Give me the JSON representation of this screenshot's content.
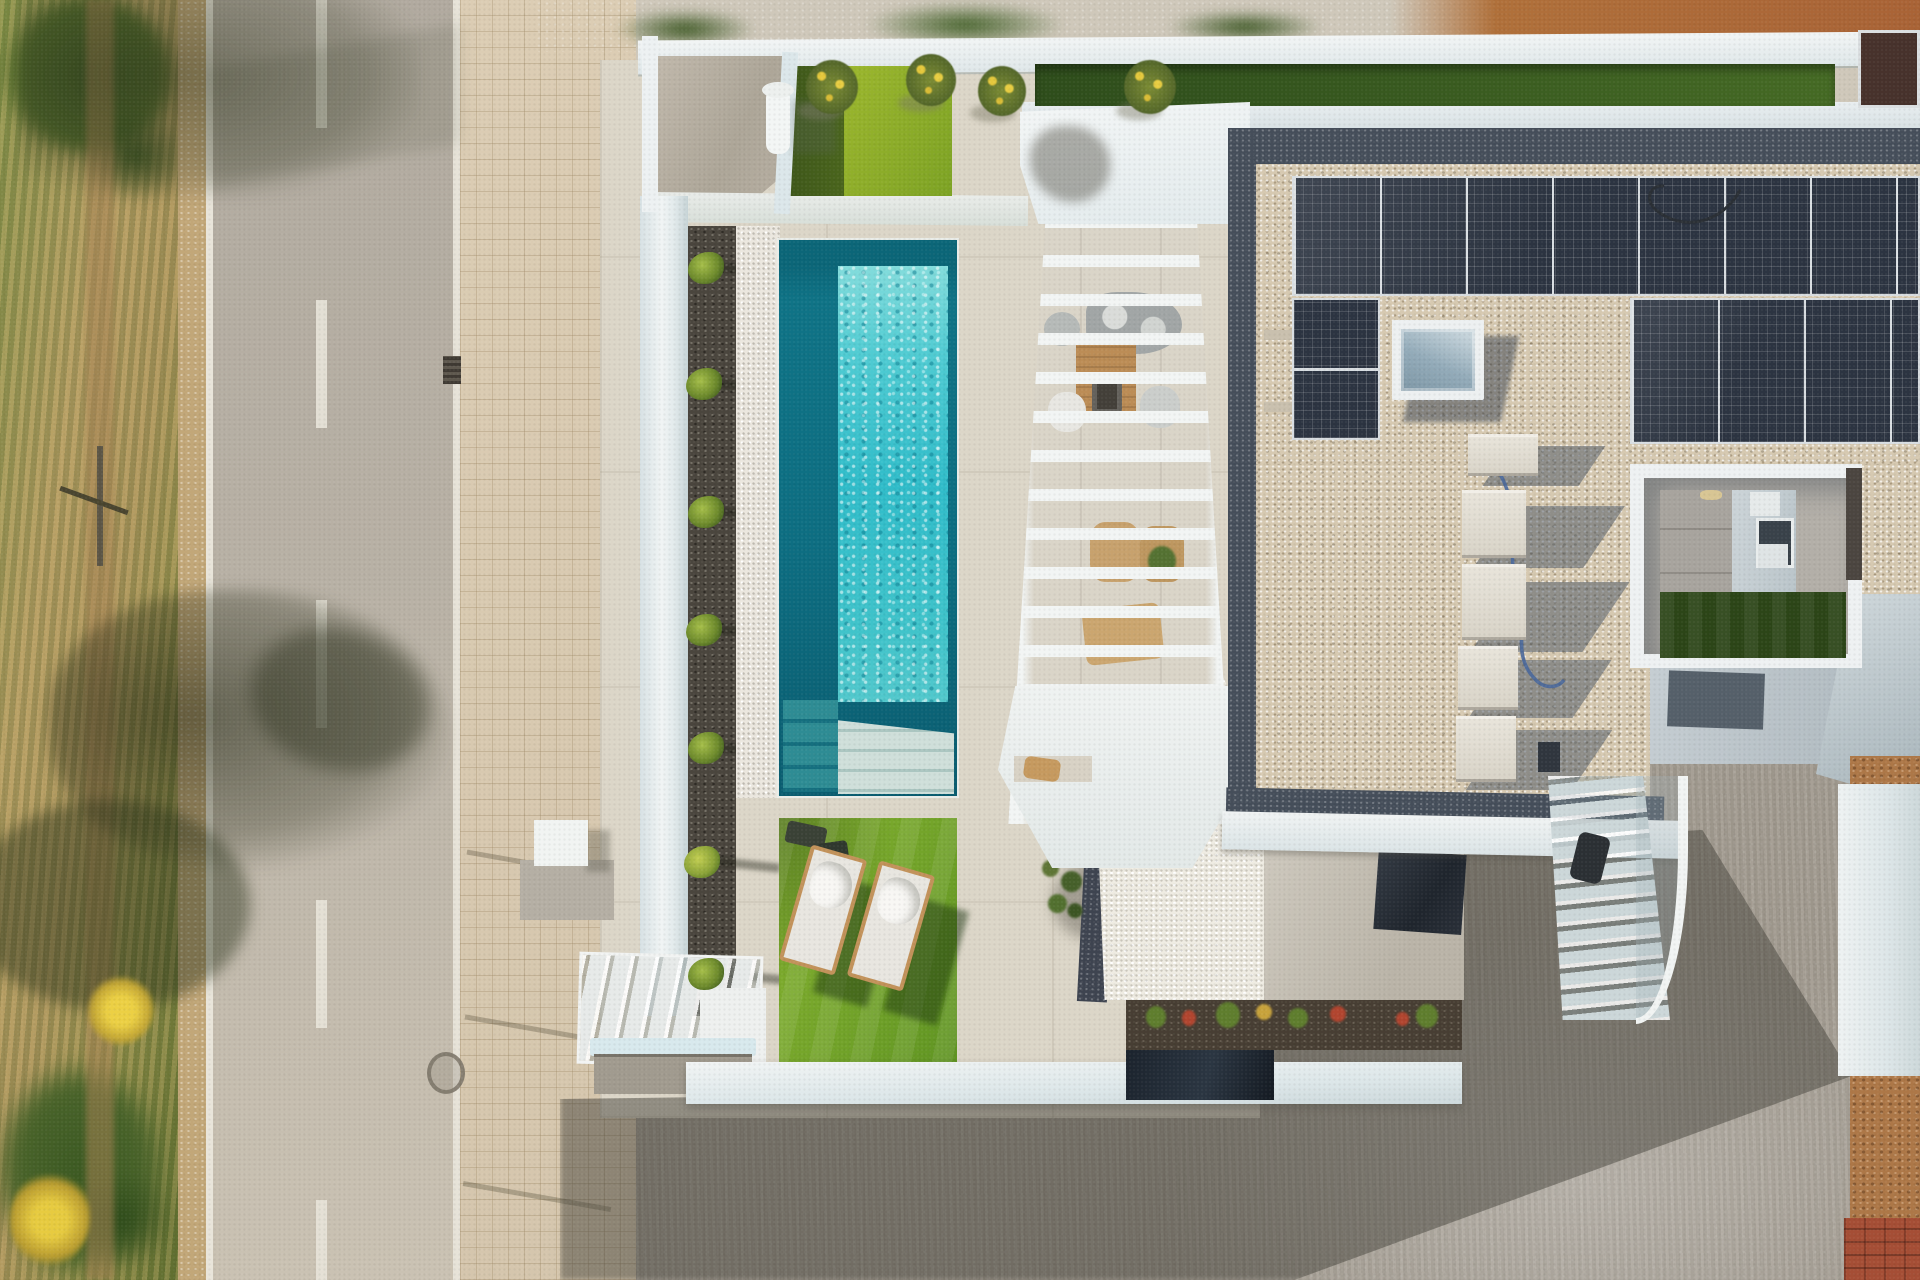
{
  "meta": {
    "title": "Aerial top-down drone photograph of a modern white villa with pool and solar roof",
    "domain": "aerial-photograph",
    "view": "top-down",
    "lighting": "bright midday sun, shadows cast to the south-east"
  },
  "palette": {
    "asphalt": "#b5aea3",
    "road_markings": "#e7e3d8",
    "sidewalk_tiles": "#d8c9b0",
    "scrub_green": "#7d8f45",
    "scrub_dry": "#b09a60",
    "bush_dark": "#3f5824",
    "flower_yellow": "#ecd044",
    "villa_white": "#eef2f3",
    "pale_blue_wall": "#d3dee1",
    "garden_paving": "#dcd6c8",
    "lawn_bright": "#8aab28",
    "lawn_dark": "#4a651c",
    "artificial_grass_strip": "#3a5c20",
    "pool_edge_teal": "#0b6678",
    "pool_water": "#45c8d2",
    "pool_steps": "#cfdfda",
    "mulch_dark": "#4a453d",
    "white_pebbles": "#ebe7df",
    "roof_gravel": "#d6c9b1",
    "roof_border_gravel": "#454e5a",
    "solar_panel": "#2c3441",
    "solar_frame": "#d9dee2",
    "skylight_glass": "#93abb9",
    "driveway_concrete": "#a29b90",
    "building_shadow": "#494640",
    "neighbor_dirt": "#ad7747",
    "brick_stack": "#a54e35",
    "wood": "#b9874d"
  },
  "street": {
    "road": {
      "surface": "asphalt",
      "center_line": {
        "style": "dashed",
        "color": "#e7e3d8",
        "dash_px": 128,
        "gap_px": 172
      },
      "edge_lines": {
        "count": 2,
        "color": "#e9e5da"
      },
      "drain_grate": {
        "present": true,
        "position": "right edge, upper third"
      },
      "manhole_cover": {
        "present": true,
        "position": "right edge, lower third"
      }
    },
    "sidewalk": {
      "pattern": "small square tiles",
      "color": "#d8c9b0",
      "fence_post_shadows": 3
    },
    "verge": {
      "description": "strip of dry scrub and grasses with bushes",
      "tree_shadows": 3,
      "yellow_flower_bushes": 2,
      "dirt_footpath": true,
      "fence_post": true
    }
  },
  "villa": {
    "boundary": {
      "white_wall": true,
      "artificial_grass_coping_strip": true,
      "entry_platform_concrete": "#b4ac9f",
      "outdoor_shower": true,
      "dark_wall_panel_top_right": "#47322c"
    },
    "garden": {
      "paving": "large-format beige porcelain tiles",
      "planting_bed": {
        "mulch": "dark volcanic gravel",
        "small_plants": 7,
        "plant_shadows": "thin, pointing east"
      },
      "white_pebble_strip": true,
      "lawn_top": {
        "dark_half": "#4a651c",
        "sunlit_half": "#9cb72e"
      },
      "lawn_bottom": {
        "color": "#72a329",
        "sun_loungers": {
          "count": 2,
          "frame": "#c2925a",
          "cushion": "#e8e6e0",
          "towels": "#f8f7f4",
          "rotation_deg": 16
        },
        "dark_mats": 2
      },
      "small_tree": true,
      "white_storage_cube": true,
      "garden_stairs": 2
    },
    "pool": {
      "shape": "long rectangle",
      "orientation": "north-south",
      "edge_color": "#0b6678",
      "water_color": "#45c8d2",
      "entry_steps": "corner steps at south end",
      "texture": "sun ripples"
    },
    "pergola": {
      "color": "#f2f5f4",
      "slats": "white horizontal fins with gaps",
      "furniture_below": [
        "gray curved sofa",
        "wooden dining table",
        "barbecue",
        "wicker chairs",
        "wooden loungers",
        "potted plant"
      ],
      "round_daybed": "#d7b485"
    },
    "roof": {
      "finish": "light gravel with dark gravel perimeter border",
      "solar_array": {
        "panel_color": "#2c3441",
        "frame": "#d9dee2",
        "layout": [
          {
            "block": "top row",
            "panels": 8,
            "orientation": "portrait"
          },
          {
            "block": "left column",
            "panels": 2,
            "orientation": "landscape"
          },
          {
            "block": "right block",
            "panels": 7,
            "orientation": "portrait"
          }
        ],
        "cables": [
          "black",
          "blue"
        ]
      },
      "skylight": {
        "frame": "#edf0f1",
        "glass": "#93abb9",
        "shadow": "south-east"
      },
      "ac_units": {
        "count": 5,
        "color": "#e8e4da",
        "long_shadows": true,
        "small_dark_unit": 1
      }
    },
    "courtyard": {
      "white_parapet": true,
      "floor": "gray tiles",
      "window": 1,
      "sill_box": true,
      "artificial_grass": "#2c4517",
      "wall_light": 1
    },
    "south_facade": {
      "lower_terrace": true,
      "dark_glass_reflection": true,
      "flower_planter": {
        "soil": "#473e33",
        "plants": [
          "green",
          "red",
          "yellow"
        ]
      },
      "dark_water_basin": "#1b232d",
      "exterior_staircase": {
        "treads": "#ccd7d9",
        "curved_glass_rail": true,
        "dark_bin": true
      }
    },
    "driveway": {
      "surface": "mottled gray concrete",
      "building_shadow": "large diagonal shadow"
    }
  },
  "neighbor_plot": {
    "bare_dirt": "#ad7747",
    "brick_stack_bottom_right": true,
    "under_construction": true
  }
}
